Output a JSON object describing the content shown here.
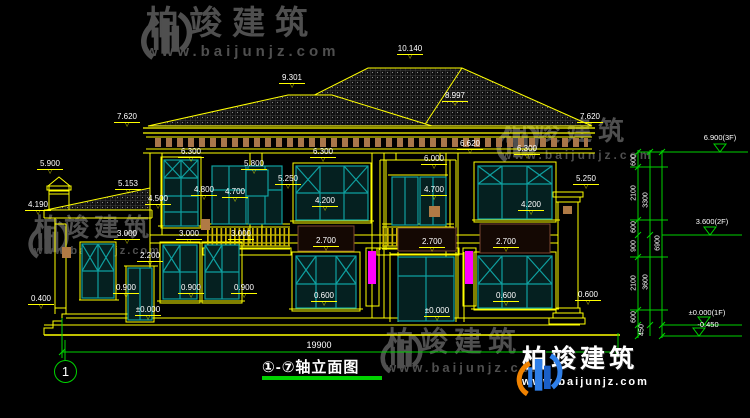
{
  "brand": {
    "name": "柏竣建筑",
    "url": "www.baijunjz.com"
  },
  "title_block": {
    "title": "①-⑦轴立面图"
  },
  "axis_bubble": "1",
  "overall_dim": "19900",
  "accent_colors": {
    "cad_yellow": "#ffff00",
    "dim_green": "#00d200",
    "window_teal": "#0fa0a0",
    "highlight_magenta": "#ff00ff",
    "logo_blue": "#2f7fe8",
    "logo_orange": "#f08200",
    "watermark_gray": "#4f4f4f"
  },
  "dim_labels": [
    {
      "t": "10.140",
      "x": 410,
      "y": 45
    },
    {
      "t": "9.301",
      "x": 292,
      "y": 74
    },
    {
      "t": "8.997",
      "x": 455,
      "y": 92
    },
    {
      "t": "7.620",
      "x": 127,
      "y": 113
    },
    {
      "t": "7.620",
      "x": 590,
      "y": 113
    },
    {
      "t": "5.900",
      "x": 50,
      "y": 160
    },
    {
      "t": "5.153",
      "x": 128,
      "y": 180
    },
    {
      "t": "4.190",
      "x": 38,
      "y": 201
    },
    {
      "t": "6.300",
      "x": 191,
      "y": 148
    },
    {
      "t": "4.500",
      "x": 158,
      "y": 195
    },
    {
      "t": "4.800",
      "x": 204,
      "y": 186
    },
    {
      "t": "4.700",
      "x": 235,
      "y": 188
    },
    {
      "t": "5.800",
      "x": 254,
      "y": 160
    },
    {
      "t": "5.250",
      "x": 288,
      "y": 175
    },
    {
      "t": "6.300",
      "x": 323,
      "y": 148
    },
    {
      "t": "4.200",
      "x": 325,
      "y": 197
    },
    {
      "t": "6.620",
      "x": 470,
      "y": 140
    },
    {
      "t": "6.000",
      "x": 434,
      "y": 155
    },
    {
      "t": "4.700",
      "x": 434,
      "y": 186
    },
    {
      "t": "6.300",
      "x": 527,
      "y": 145
    },
    {
      "t": "4.200",
      "x": 531,
      "y": 201
    },
    {
      "t": "5.250",
      "x": 586,
      "y": 175
    },
    {
      "t": "3.000",
      "x": 127,
      "y": 230
    },
    {
      "t": "3.000",
      "x": 189,
      "y": 230
    },
    {
      "t": "3.000",
      "x": 241,
      "y": 230
    },
    {
      "t": "2.200",
      "x": 150,
      "y": 252
    },
    {
      "t": "2.700",
      "x": 326,
      "y": 237
    },
    {
      "t": "2.700",
      "x": 432,
      "y": 238
    },
    {
      "t": "2.700",
      "x": 506,
      "y": 238
    },
    {
      "t": "0.900",
      "x": 126,
      "y": 284
    },
    {
      "t": "0.900",
      "x": 191,
      "y": 284
    },
    {
      "t": "0.900",
      "x": 244,
      "y": 284
    },
    {
      "t": "0.400",
      "x": 41,
      "y": 295
    },
    {
      "t": "0.600",
      "x": 324,
      "y": 292
    },
    {
      "t": "0.600",
      "x": 506,
      "y": 292
    },
    {
      "t": "0.600",
      "x": 588,
      "y": 291
    },
    {
      "t": "±0.000",
      "x": 148,
      "y": 306
    },
    {
      "t": "±0.000",
      "x": 437,
      "y": 307
    }
  ],
  "right_chain": {
    "segments": [
      {
        "t": "600",
        "x": 634,
        "y": 160
      },
      {
        "t": "2100",
        "x": 634,
        "y": 193
      },
      {
        "t": "3300",
        "x": 646,
        "y": 200
      },
      {
        "t": "600",
        "x": 634,
        "y": 227
      },
      {
        "t": "900",
        "x": 634,
        "y": 246
      },
      {
        "t": "6900",
        "x": 658,
        "y": 243
      },
      {
        "t": "2100",
        "x": 634,
        "y": 283
      },
      {
        "t": "3600",
        "x": 646,
        "y": 282
      },
      {
        "t": "600",
        "x": 634,
        "y": 317
      },
      {
        "t": "450",
        "x": 642,
        "y": 330
      }
    ],
    "levels": [
      {
        "t": "6.900(3F)",
        "x": 720,
        "y": 133
      },
      {
        "t": "3.600(2F)",
        "x": 712,
        "y": 217
      },
      {
        "t": "±0.000(1F)",
        "x": 707,
        "y": 308
      },
      {
        "t": "-0.450",
        "x": 708,
        "y": 320
      }
    ]
  }
}
